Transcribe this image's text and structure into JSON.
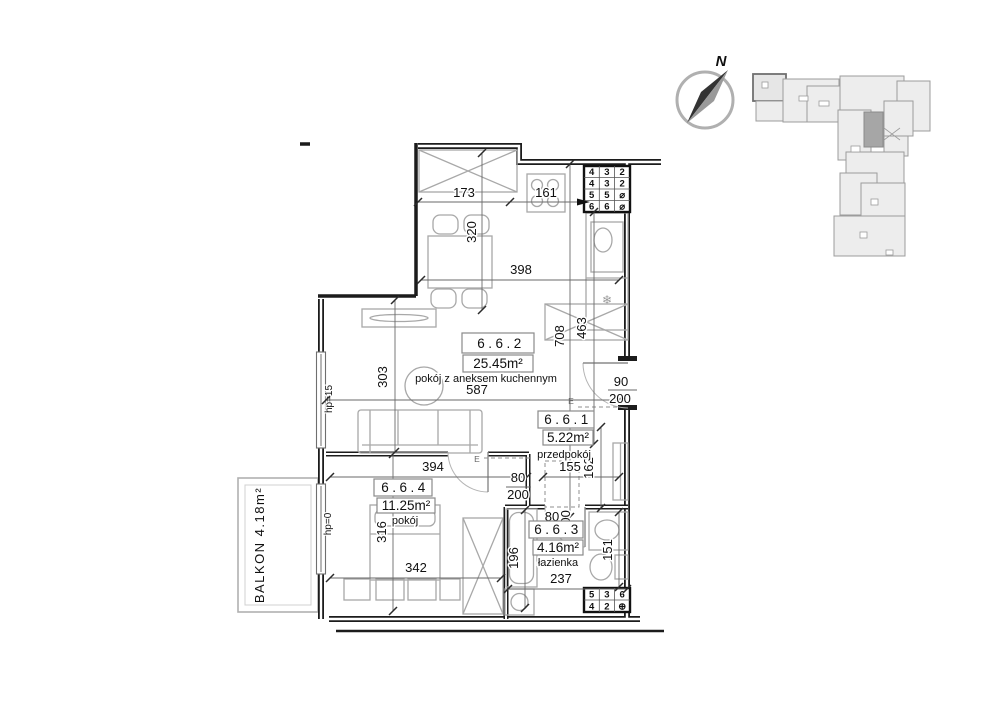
{
  "compass": {
    "north": "N"
  },
  "rooms": [
    {
      "id": "6.6.2",
      "area": "25.45m²",
      "name": "pokój z aneksem kuchennym"
    },
    {
      "id": "6.6.1",
      "area": "5.22m²",
      "name": "przedpokój"
    },
    {
      "id": "6.6.3",
      "area": "4.16m²",
      "name": "łazienka"
    },
    {
      "id": "6.6.4",
      "area": "11.25m²",
      "name": "pokój"
    }
  ],
  "balcony": {
    "label": "BALKON 4.18m²"
  },
  "windows": {
    "upper": "hp=15",
    "lower": "hp=0"
  },
  "dims": {
    "kitchen_top_left": "173",
    "kitchen_top_right": "161",
    "kitchen_depth": "320",
    "living_top_width": "398",
    "kitchen_wall": "463",
    "living_height": "708",
    "living_width": "587",
    "living_left": "303",
    "entrance_w": "90",
    "entrance_h": "200",
    "hall_width": "155",
    "hall_depth": "162",
    "room_top": "394",
    "room_left": "316",
    "room_bottom": "342",
    "door_w": "80",
    "door_h": "200",
    "bath_door_w": "80",
    "bath_door_h": "200",
    "tub_len": "196",
    "bath_width": "237",
    "bath_right": "151"
  },
  "beams": {
    "label": "E"
  },
  "icons": {
    "fridge": "❄"
  },
  "shafts": {
    "top_rows": [
      [
        "4",
        "3",
        "2"
      ],
      [
        "4",
        "3",
        "2"
      ],
      [
        "5",
        "5",
        "⌀"
      ],
      [
        "6",
        "6",
        "⌀"
      ]
    ],
    "bottom_rows": [
      [
        "5",
        "3",
        "6"
      ],
      [
        "4",
        "2",
        "⊕"
      ]
    ]
  },
  "colors": {
    "wall": "#1c1c1c",
    "furniture": "#a8a8a8",
    "keymap_fill": "#ededed",
    "keymap_stroke": "#9c9c9c",
    "keymap_highlight": "#a6a6a6"
  }
}
